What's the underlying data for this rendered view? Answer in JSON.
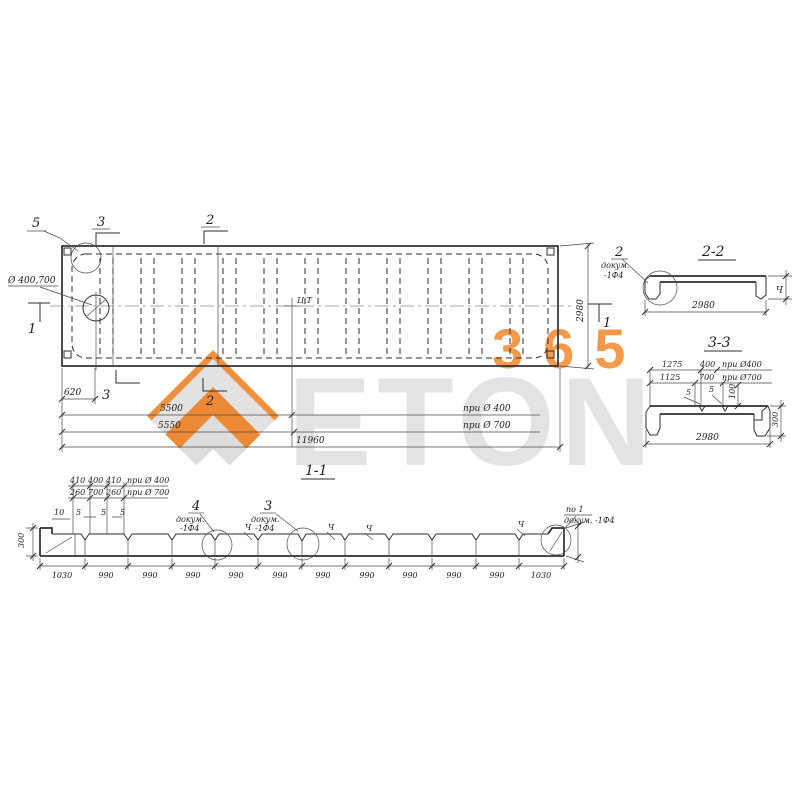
{
  "watermark": {
    "brand": "ETON",
    "number": "365",
    "orange": "#F2913D",
    "gray": "#E2E2E2"
  },
  "plan": {
    "label_detail5": "5",
    "label_sec3_top": "3",
    "label_sec2_top": "2",
    "label_sec3_bot": "3",
    "label_sec2_bot": "2",
    "label_sec1_left": "1",
    "label_sec1_right": "1",
    "hole_note": "Ø 400,700",
    "cg_label": "Ц.Т",
    "width_dim": "2980",
    "dim_620": "620",
    "dim_5500": "5500",
    "cond_400": "при Ø 400",
    "dim_5550": "5550",
    "cond_700": "при Ø 700",
    "dim_total": "11960"
  },
  "section22": {
    "title": "2-2",
    "detail_label": "2",
    "note_line1": "докум.",
    "note_line2": "-1Ф4",
    "width_dim": "2980",
    "height_label": "Ч"
  },
  "section33": {
    "title": "3-3",
    "dim_1275": "1275",
    "dim_400": "400",
    "cond_400": "при Ø400",
    "dim_1125": "1125",
    "dim_700": "700",
    "cond_700": "при Ø700",
    "dim_5a": "5",
    "dim_5b": "5",
    "dim_100": "100",
    "dim_300": "300",
    "width_dim": "2980"
  },
  "section11": {
    "title": "1-1",
    "row1": [
      "410",
      "400",
      "410",
      "при Ø 400"
    ],
    "row2": [
      "260",
      "700",
      "260",
      "при Ø 700"
    ],
    "row3": [
      "10",
      "5",
      "5",
      "5"
    ],
    "height_left": "300",
    "detail4_label": "4",
    "detail4_note1": "докум.",
    "detail4_note2": "-1Ф4",
    "detail3_label": "3",
    "detail3_note1": "докум.",
    "detail3_note2": "-1Ф4",
    "right_note1": "по 1",
    "right_note2": "докум. -1Ф4",
    "h_marks": [
      "Ч",
      "Ч",
      "Ч",
      "Ч"
    ],
    "segments": [
      "1030",
      "990",
      "990",
      "990",
      "990",
      "990",
      "990",
      "990",
      "990",
      "990",
      "990",
      "1030"
    ]
  }
}
